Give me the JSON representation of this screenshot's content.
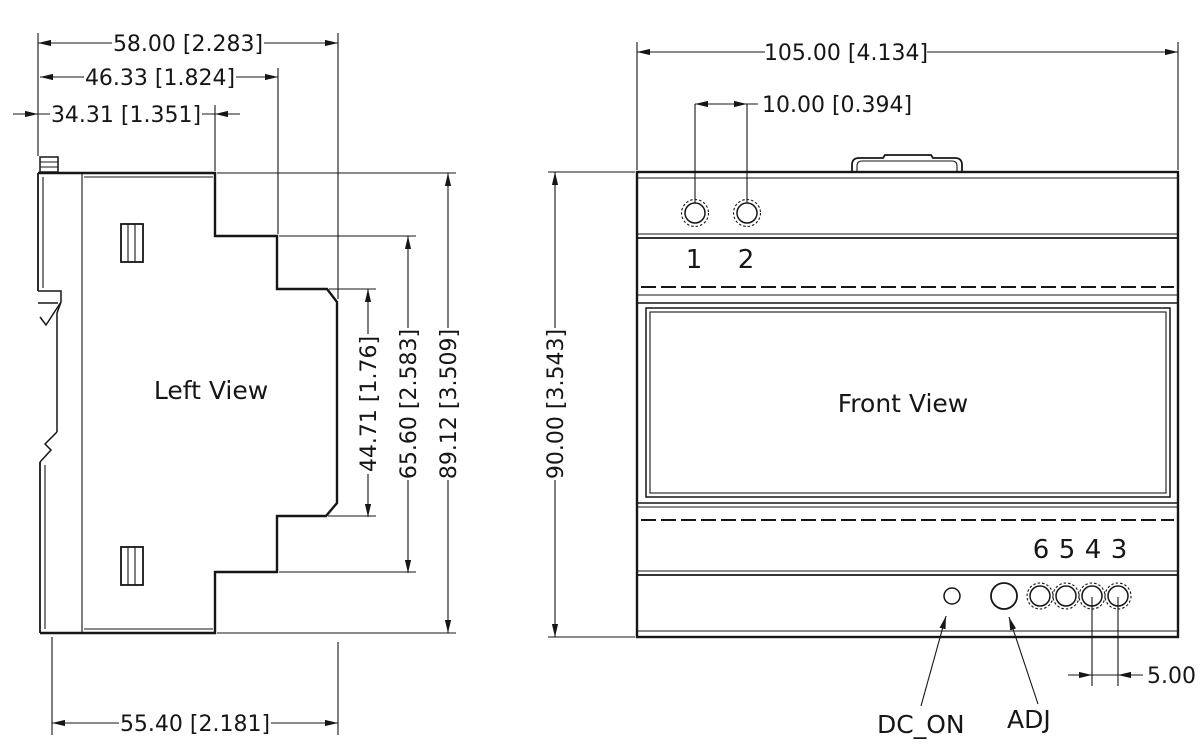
{
  "drawing": {
    "colors": {
      "line": "#161616",
      "background": "#ffffff"
    },
    "left_view": {
      "label": "Left View",
      "dims": {
        "width_total": "58.00 [2.283]",
        "width_mid": "46.33 [1.824]",
        "width_top": "34.31 [1.351]",
        "front_face_height": "44.71 [1.76]",
        "mid_height": "65.60 [2.583]",
        "total_height": "89.12 [3.509]",
        "width_bottom": "55.40 [2.181]"
      }
    },
    "front_view": {
      "label": "Front View",
      "dims": {
        "width_total": "105.00 [4.134]",
        "top_terminal_pitch": "10.00 [0.394]",
        "total_height": "90.00 [3.543]",
        "bottom_terminal_pitch": "5.00"
      },
      "terminals_top": [
        "1",
        "2"
      ],
      "terminals_bottom": [
        "6",
        "5",
        "4",
        "3"
      ],
      "indicators": {
        "led_label": "DC_ON",
        "adj_label": "ADJ"
      }
    }
  }
}
